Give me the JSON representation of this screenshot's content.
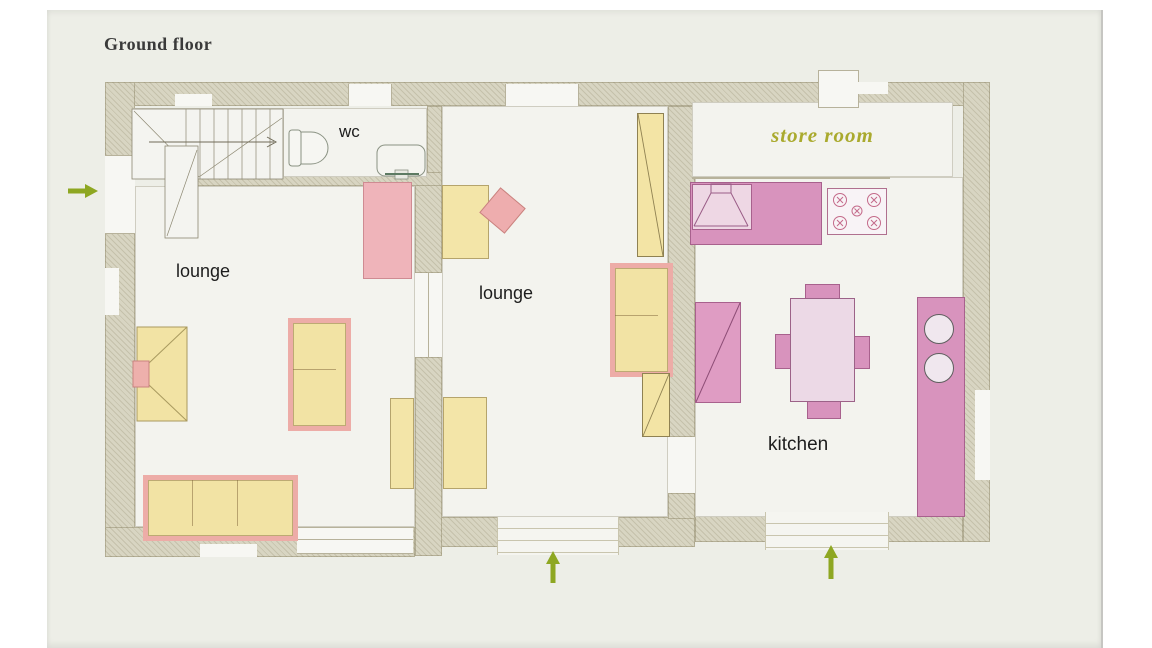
{
  "title": "Ground floor",
  "rooms": {
    "lounge_left": {
      "label": "lounge"
    },
    "lounge_middle": {
      "label": "lounge"
    },
    "wc": {
      "label": "wc"
    },
    "store_room": {
      "label": "store room"
    },
    "kitchen": {
      "label": "kitchen"
    }
  },
  "entrances": [
    {
      "wall": "left",
      "direction": "right"
    },
    {
      "wall": "bottom-lounge",
      "direction": "up"
    },
    {
      "wall": "bottom-kitchen",
      "direction": "up"
    }
  ],
  "palette": {
    "paper": "#ffffff",
    "photo_background": "#edeee7",
    "wall_beige": "#d8d5c2",
    "room_fill": "#f3f3ee",
    "furniture_yellow": "#f3e5a8",
    "sofa_pink": "#edaca7",
    "sideboard_pink": "#efb4ba",
    "kitchen_pink": "#d893bd",
    "table_pink": "#ecd9e6",
    "store_room_text": "#aaaa2e",
    "arrow_green": "#8ea722",
    "title_color": "#3a3a3a"
  }
}
